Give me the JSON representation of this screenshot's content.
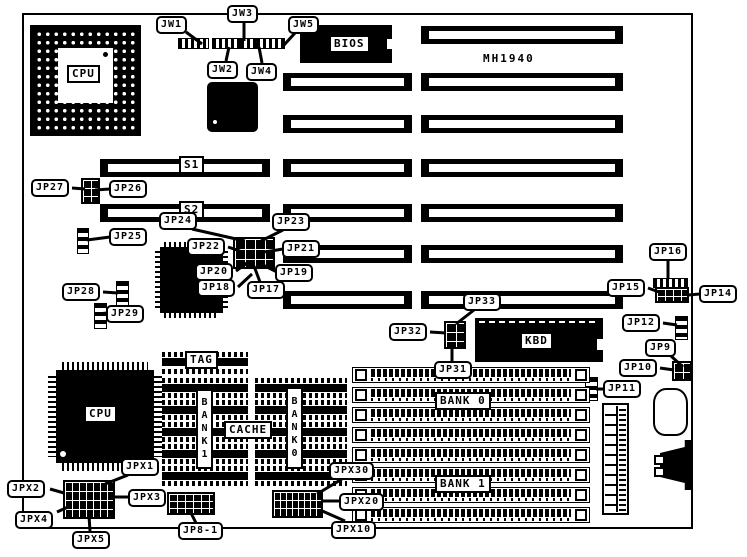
{
  "labels": {
    "model": "MH1940",
    "cpu_socket": "CPU",
    "cpu_qfp": "CPU",
    "bios": "BIOS",
    "kbd": "KBD",
    "slot_s1": "S1",
    "slot_s2": "S2",
    "tag": "TAG",
    "cache": "CACHE",
    "cache_bank1": "BANK1",
    "cache_bank0": "BANK0",
    "mem_bank0": "BANK 0",
    "mem_bank1": "BANK 1"
  },
  "callouts": {
    "jw1": "JW1",
    "jw2": "JW2",
    "jw3": "JW3",
    "jw4": "JW4",
    "jw5": "JW5",
    "jp27": "JP27",
    "jp26": "JP26",
    "jp25": "JP25",
    "jp24": "JP24",
    "jp23": "JP23",
    "jp22": "JP22",
    "jp21": "JP21",
    "jp20": "JP20",
    "jp19": "JP19",
    "jp18": "JP18",
    "jp17": "JP17",
    "jp28": "JP28",
    "jp29": "JP29",
    "jp16": "JP16",
    "jp15": "JP15",
    "jp14": "JP14",
    "jp12": "JP12",
    "jp9": "JP9",
    "jp10": "JP10",
    "jp11": "JP11",
    "jp33": "JP33",
    "jp32": "JP32",
    "jp31": "JP31",
    "jpx1": "JPX1",
    "jpx2": "JPX2",
    "jpx3": "JPX3",
    "jpx4": "JPX4",
    "jpx5": "JPX5",
    "jp8_1": "JP8-1",
    "jpx30": "JPX30",
    "jpx20": "JPX20",
    "jpx10": "JPX10"
  }
}
